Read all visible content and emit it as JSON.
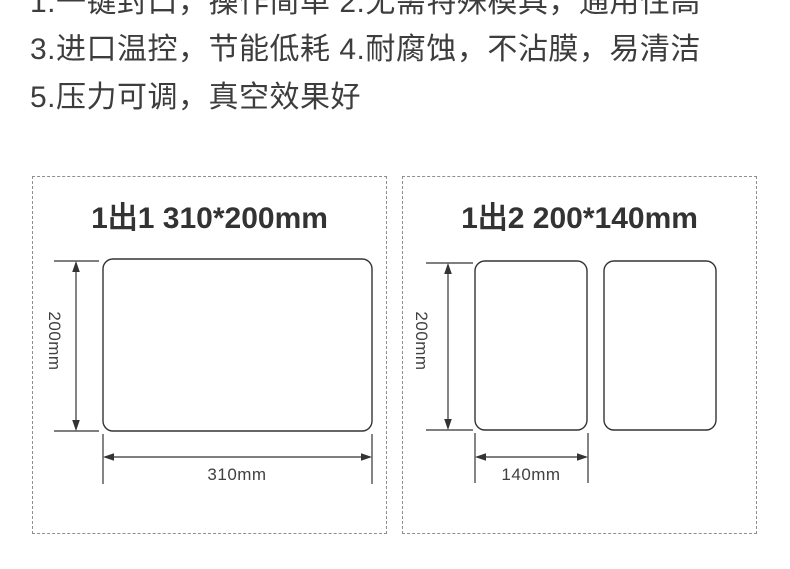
{
  "features": {
    "line1": "1.一键封口，操作简单 2.无需特殊模具，通用性高",
    "line2": "3.进口温控，节能低耗 4.耐腐蚀，不沾膜，易清洁",
    "line3": "5.压力可调，真空效果好"
  },
  "panels": [
    {
      "title": "1出1 310*200mm",
      "height_label": "200mm",
      "width_label": "310mm",
      "pouch_count": 1
    },
    {
      "title": "1出2 200*140mm",
      "height_label": "200mm",
      "width_label": "140mm",
      "pouch_count": 2
    }
  ],
  "colors": {
    "text": "#3d3d3d",
    "title": "#333333",
    "stroke": "#333333",
    "dash_border": "#8f8f8f",
    "background": "#ffffff"
  }
}
